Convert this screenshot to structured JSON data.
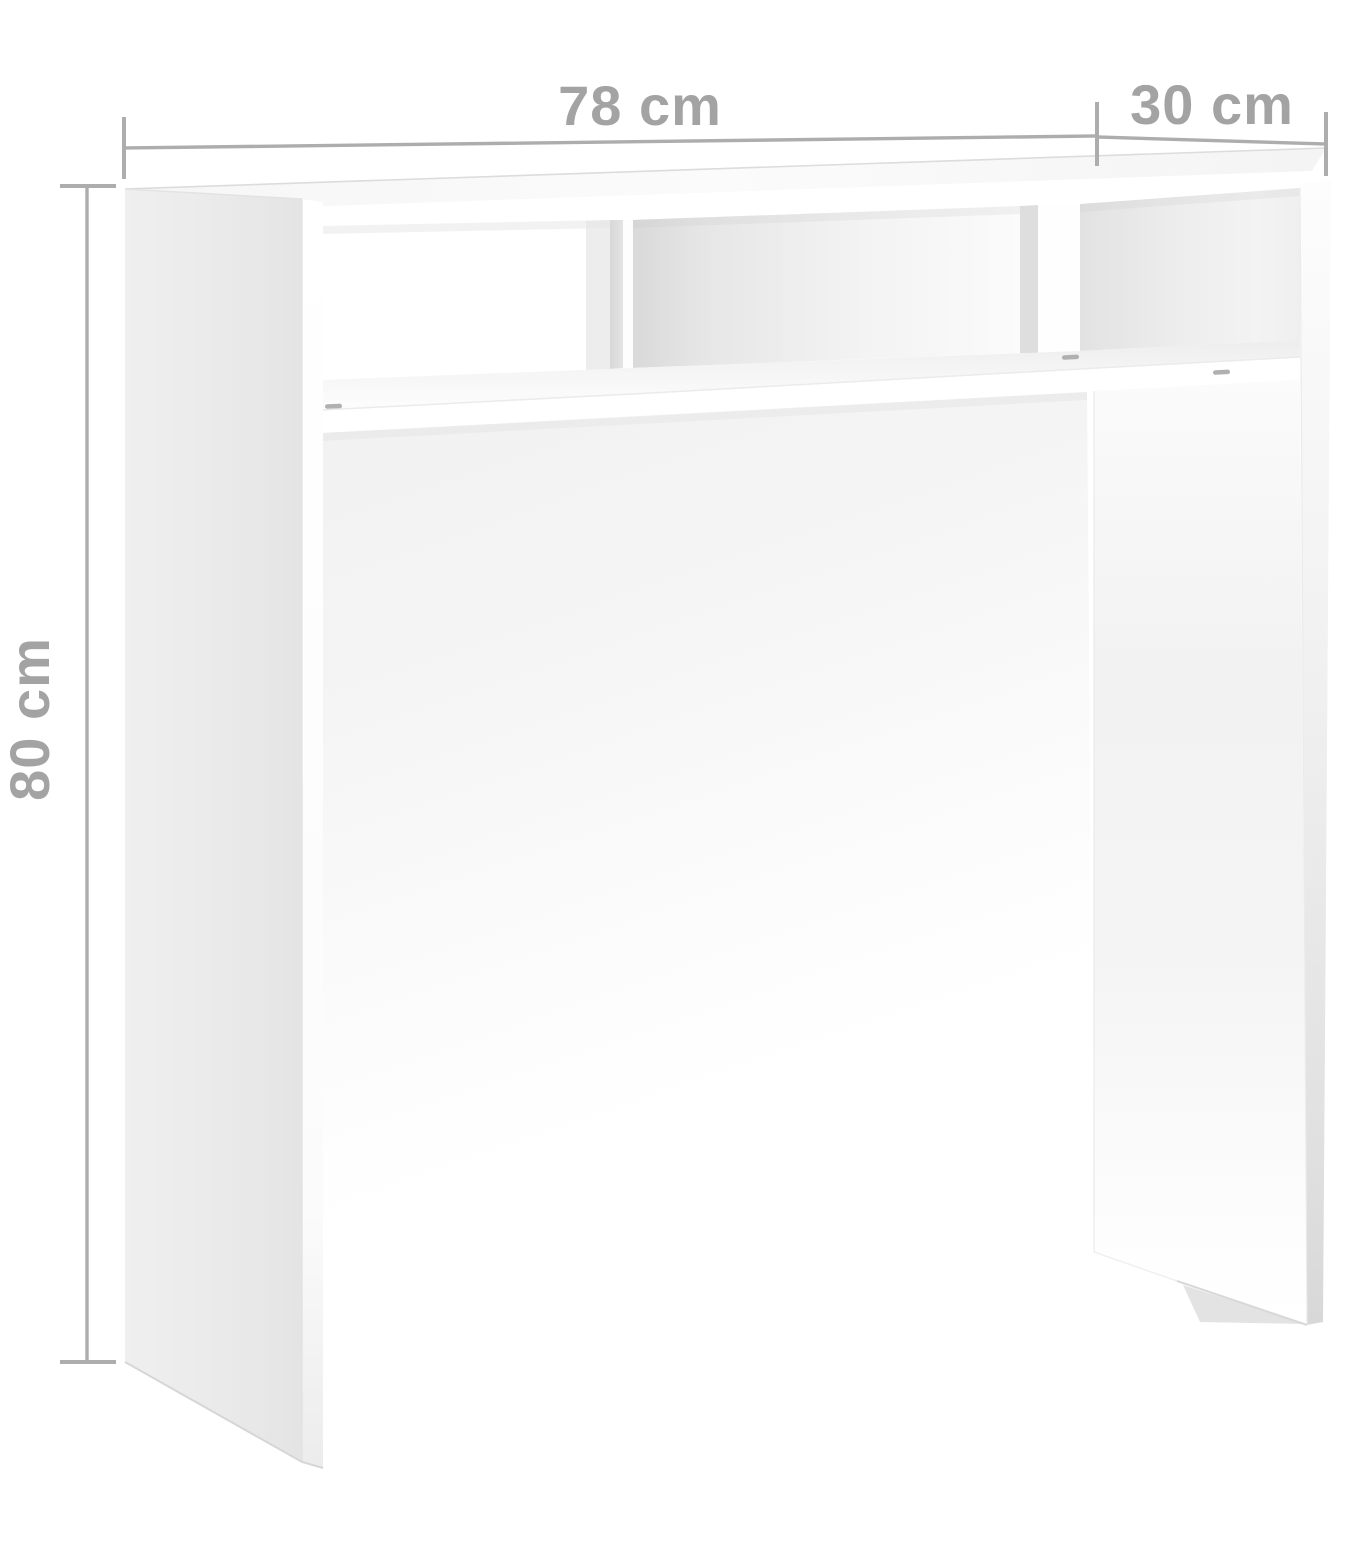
{
  "title": "Console table dimension diagram",
  "product": "console-table",
  "dimensions": {
    "width_label": "78 cm",
    "depth_label": "30 cm",
    "height_label": "80 cm"
  },
  "colors": {
    "background": "#ffffff",
    "dim-line": "#adadad",
    "dim-text": "#a3a3a3",
    "panel-side": "#e9e9e9",
    "interior-shadow": "#dedede",
    "edge-line": "#dfdfdf",
    "screw": "#b0b0b0"
  }
}
